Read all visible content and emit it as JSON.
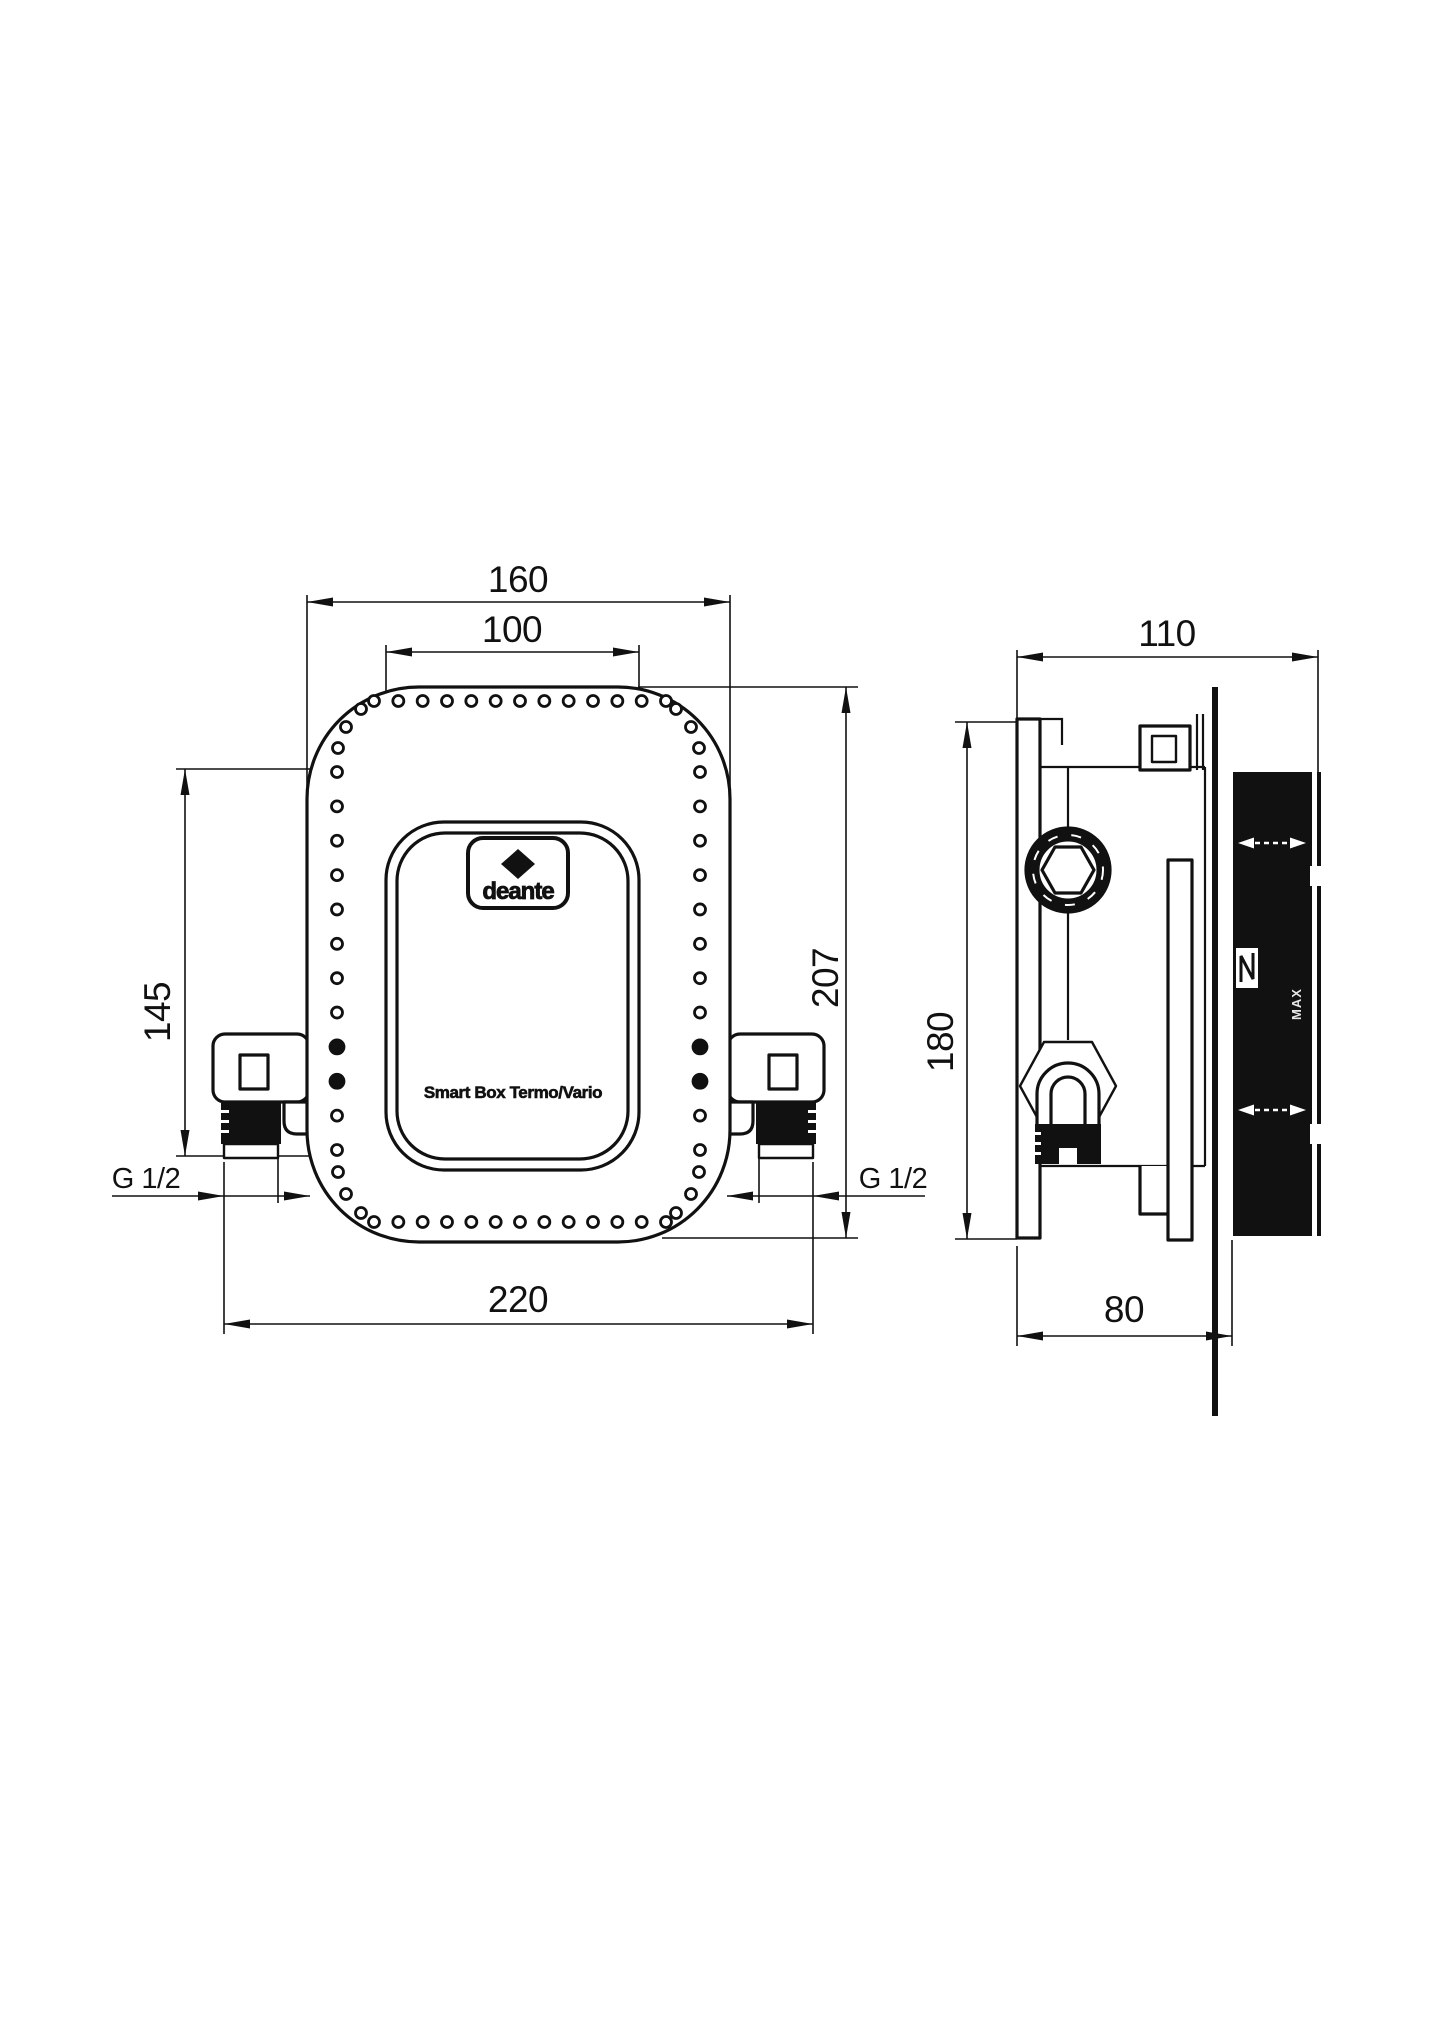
{
  "drawing": {
    "logo_text": "deante",
    "product_label": "Smart Box Termo/Vario",
    "front_view": {
      "dim_width_outer": "160",
      "dim_width_cover": "100",
      "dim_height_left": "145",
      "dim_height_right": "207",
      "dim_width_bottom": "220",
      "thread_left": "G 1/2",
      "thread_right": "G 1/2"
    },
    "side_view": {
      "dim_depth_top": "110",
      "dim_height": "180",
      "dim_depth_bottom": "80",
      "max_label": "MAX"
    },
    "hole_ring": {
      "r": 5.5,
      "filled_r": 7,
      "top": {
        "y": 701,
        "x1": 374,
        "x2": 666,
        "count": 13
      },
      "bottom": {
        "y": 1222,
        "x1": 374,
        "x2": 666,
        "count": 13
      },
      "left": {
        "x": 337,
        "y1": 772,
        "y2": 1150,
        "count": 12,
        "filled": [
          8,
          9
        ]
      },
      "right": {
        "x": 700,
        "y1": 772,
        "y2": 1150,
        "count": 12,
        "filled": [
          8,
          9
        ]
      },
      "corners": [
        [
          361,
          709
        ],
        [
          346,
          727
        ],
        [
          338,
          748
        ],
        [
          676,
          709
        ],
        [
          691,
          727
        ],
        [
          699,
          748
        ],
        [
          338,
          1172
        ],
        [
          346,
          1194
        ],
        [
          361,
          1213
        ],
        [
          699,
          1172
        ],
        [
          691,
          1194
        ],
        [
          676,
          1213
        ]
      ]
    }
  }
}
